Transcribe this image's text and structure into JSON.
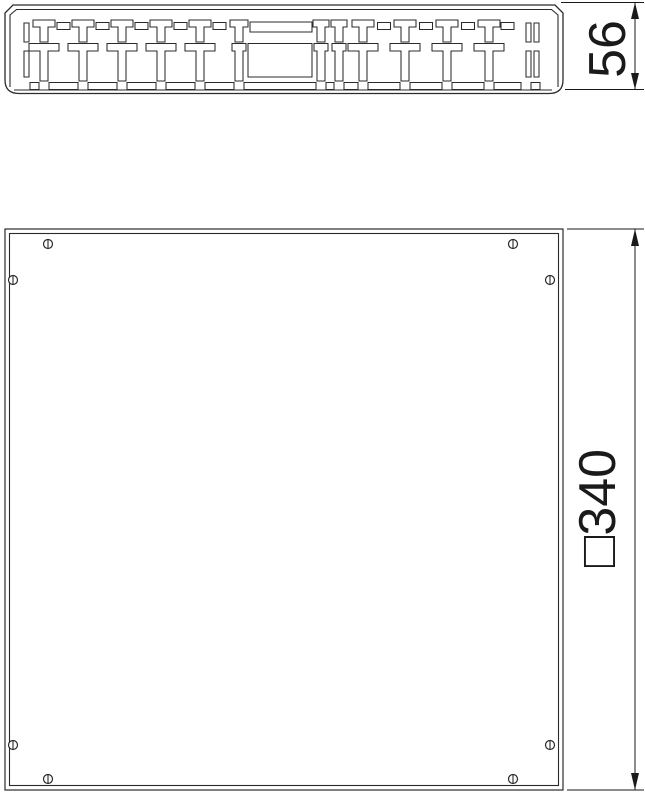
{
  "drawing": {
    "background_color": "#ffffff",
    "line_color": "#2b2b2b",
    "text_color": "#1a1a1a",
    "side_view": {
      "dimension_label": "56"
    },
    "plan_view": {
      "dimension_label": "□340",
      "screw_count": 8
    }
  }
}
